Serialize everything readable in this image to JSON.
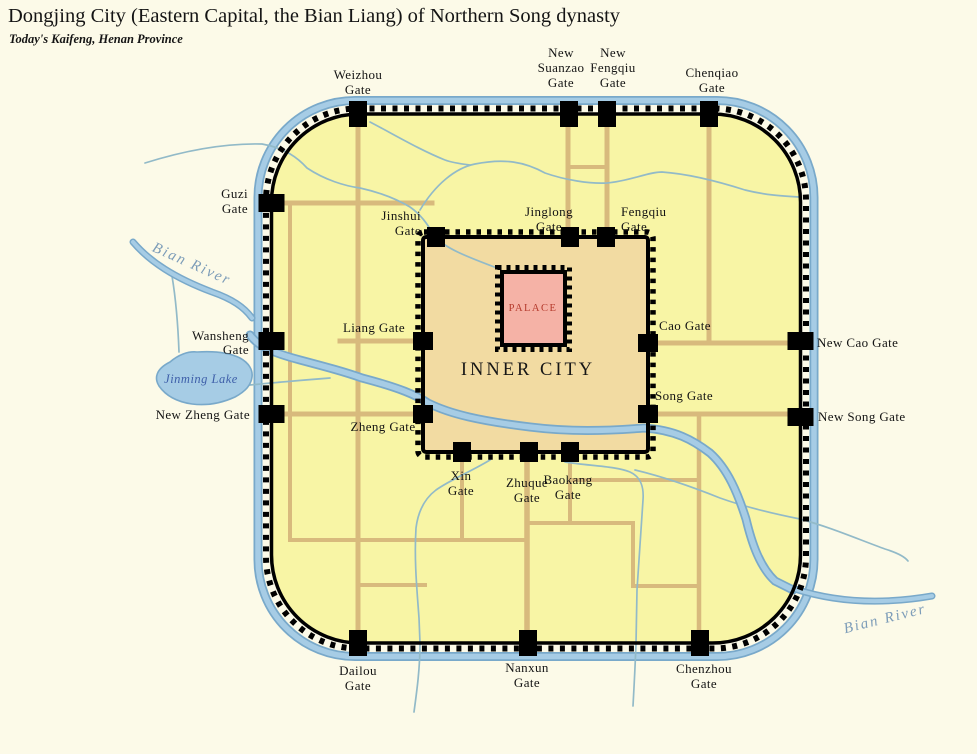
{
  "header": {
    "title": "Dongjing City (Eastern Capital, the Bian Liang) of Northern Song dynasty",
    "subtitle": "Today's Kaifeng, Henan Province"
  },
  "map": {
    "outer_gates": [
      {
        "id": "weizhou",
        "lines": [
          "Weizhou",
          "Gate"
        ]
      },
      {
        "id": "new-suanzao",
        "lines": [
          "New",
          "Suanzao",
          "Gate"
        ]
      },
      {
        "id": "new-fengqiu",
        "lines": [
          "New",
          "Fengqiu",
          "Gate"
        ]
      },
      {
        "id": "chenqiao",
        "lines": [
          "Chenqiao",
          "Gate"
        ]
      },
      {
        "id": "guzi",
        "lines": [
          "Guzi",
          "Gate"
        ]
      },
      {
        "id": "wansheng",
        "lines": [
          "Wansheng",
          "Gate"
        ]
      },
      {
        "id": "new-zheng",
        "lines": [
          "New Zheng Gate"
        ]
      },
      {
        "id": "new-cao",
        "lines": [
          "New Cao Gate"
        ]
      },
      {
        "id": "new-song",
        "lines": [
          "New Song Gate"
        ]
      },
      {
        "id": "dailou",
        "lines": [
          "Dailou",
          "Gate"
        ]
      },
      {
        "id": "nanxun",
        "lines": [
          "Nanxun",
          "Gate"
        ]
      },
      {
        "id": "chenzhou",
        "lines": [
          "Chenzhou",
          "Gate"
        ]
      }
    ],
    "inner_gates": [
      {
        "id": "jinshui",
        "lines": [
          "Jinshui",
          "Gate"
        ]
      },
      {
        "id": "jinglong",
        "lines": [
          "Jinglong",
          "Gate"
        ]
      },
      {
        "id": "fengqiu",
        "lines": [
          "Fengqiu",
          "Gate"
        ]
      },
      {
        "id": "liang",
        "lines": [
          "Liang Gate"
        ]
      },
      {
        "id": "zheng",
        "lines": [
          "Zheng Gate"
        ]
      },
      {
        "id": "cao",
        "lines": [
          "Cao Gate"
        ]
      },
      {
        "id": "song",
        "lines": [
          "Song Gate"
        ]
      },
      {
        "id": "xin",
        "lines": [
          "Xin",
          "Gate"
        ]
      },
      {
        "id": "zhuque",
        "lines": [
          "Zhuque",
          "Gate"
        ]
      },
      {
        "id": "baokang",
        "lines": [
          "Baokang",
          "Gate"
        ]
      }
    ],
    "areas": {
      "inner_city": "INNER CITY",
      "palace": "PALACE"
    },
    "water": {
      "bian_river": "Bian River",
      "jinming_lake": "Jinming Lake"
    },
    "colors": {
      "bg": "#FCFAE8",
      "ink": "#141414",
      "outer_fill": "#F8F5A5",
      "inner_fill": "#F2DBA2",
      "palace_fill": "#F5B2A6",
      "palace_text": "#B53A2C",
      "road": "#D8BA7D",
      "river_edge": "#79A9CA",
      "river_core": "#A6CCE5",
      "stream": "#92BAC8",
      "river_label": "#7C9CB8",
      "lake_label": "#3E5FA9",
      "wall": "#000000"
    }
  }
}
